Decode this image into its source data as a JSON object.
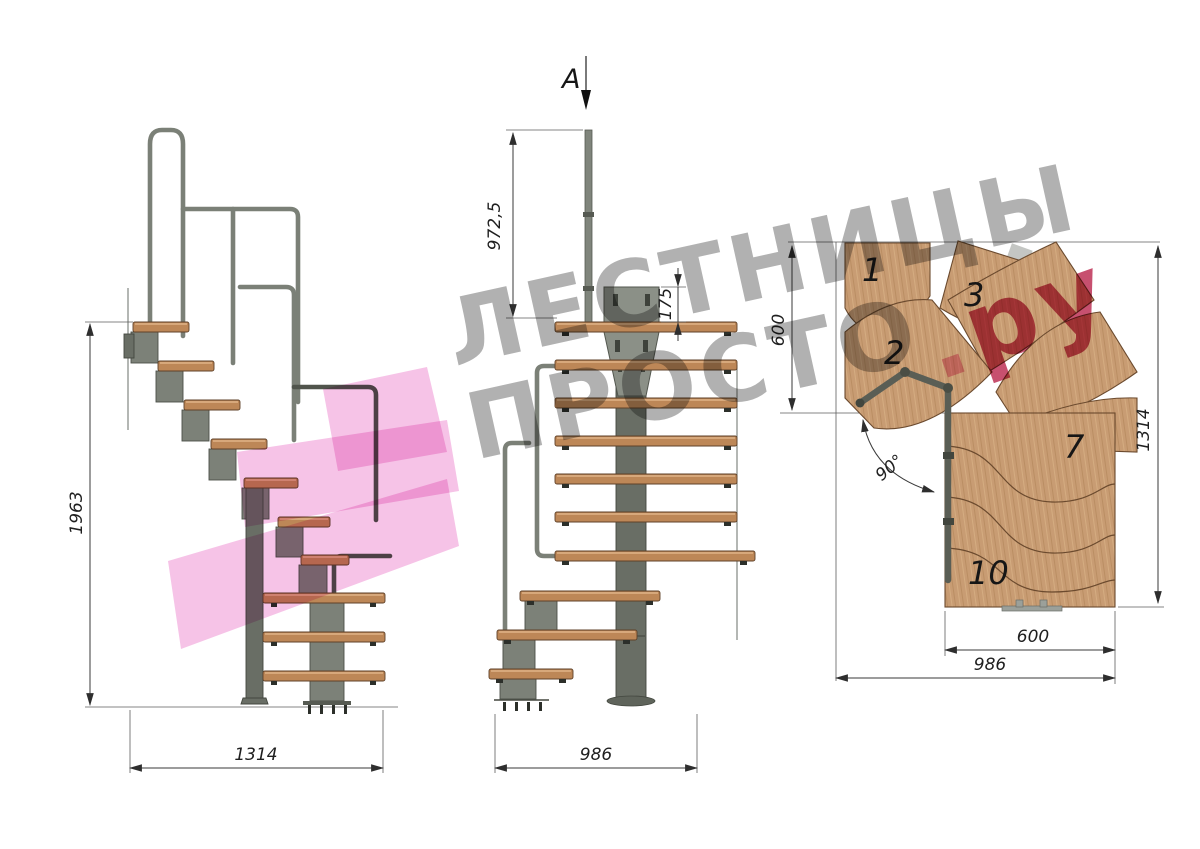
{
  "section_marker": {
    "label": "A"
  },
  "side_view": {
    "dim_height": "1963",
    "dim_width": "1314"
  },
  "front_view": {
    "dim_rail_height": "972,5",
    "dim_plate_height": "175",
    "dim_width": "986"
  },
  "plan_view": {
    "dim_entry_depth": "600",
    "dim_length": "1314",
    "dim_run_width": "600",
    "dim_total_width": "986",
    "dim_angle": "90°",
    "steps": {
      "step1": "1",
      "step2": "2",
      "step3": "3",
      "step7": "7",
      "step10": "10"
    }
  },
  "watermark": {
    "line1": "ЛЕСТНИЦЫ",
    "line2": "ПРОСТО",
    "dot": ".",
    "domain": "ру"
  },
  "colors": {
    "wood_plan": "#c89c73",
    "wood_side": "#bd8757",
    "metal": "#7c8178",
    "handrail": "#7b8077",
    "dimension": "#3a3a3a",
    "watermark_gray": "#b1b1b1",
    "watermark_pink": "#c7506f",
    "watermark_dot_pink": "#efa3c3",
    "logo_pink": "#f6c3e7"
  }
}
